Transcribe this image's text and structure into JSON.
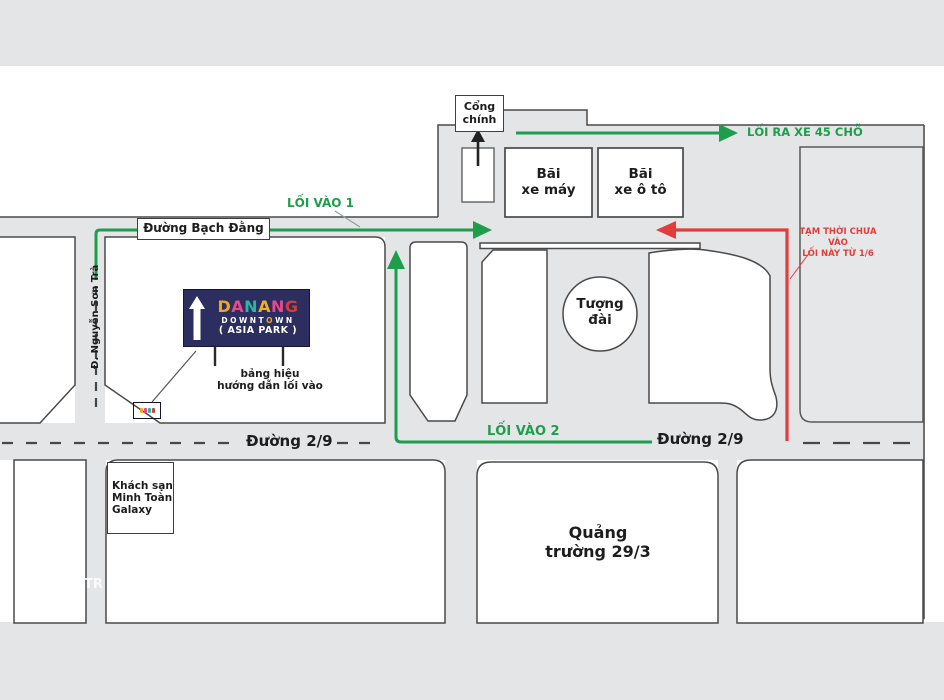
{
  "gate": {
    "label": "Cổng\nchính"
  },
  "parking": {
    "moto": "Bãi\nxe máy",
    "car": "Bãi\nxe ô tô"
  },
  "routes": {
    "exit_bus_label": "LỐI RA XE 45 CHỖ",
    "entrance1_label": "LỐI VÀO 1",
    "entrance2_label": "LỐI VÀO 2",
    "closed_note": "TẠM THỜI CHƯA VÀO\nLỐI NÀY TỪ 1/6"
  },
  "streets": {
    "bach_dang": "Đường Bạch Đằng",
    "nguyen_son_tra": "Đ. Nguyễn Sơn Trà",
    "d29_left": "Đường 2/9",
    "d29_right": "Đường 2/9"
  },
  "places": {
    "monument": "Tượng\nđài",
    "hotel": "Khách sạn\nMinh Toàn\nGalaxy",
    "square": "Quảng\ntrường 29/3"
  },
  "billboard": {
    "bg": "#2b2e5e",
    "title_letters": [
      {
        "ch": "D",
        "color": "#f2a71b"
      },
      {
        "ch": "A",
        "color": "#e8498a"
      },
      {
        "ch": "N",
        "color": "#2ab5a5"
      },
      {
        "ch": "A",
        "color": "#f2b01e"
      },
      {
        "ch": "N",
        "color": "#e8498a"
      },
      {
        "ch": "G",
        "color": "#cf3f39"
      }
    ],
    "subtitle_letters": [
      {
        "ch": "D",
        "color": "#ffffff"
      },
      {
        "ch": "O",
        "color": "#ffffff"
      },
      {
        "ch": "W",
        "color": "#ffffff"
      },
      {
        "ch": "N",
        "color": "#ffffff"
      },
      {
        "ch": "T",
        "color": "#ffffff"
      },
      {
        "ch": "O",
        "color": "#f2a71b"
      },
      {
        "ch": "W",
        "color": "#ffffff"
      },
      {
        "ch": "N",
        "color": "#ffffff"
      }
    ],
    "line3": "( ASIA PARK )",
    "caption": "bảng hiệu\nhướng dẫn lối vào"
  },
  "watermark": "TR",
  "colors": {
    "green": "#1e9e4c",
    "red": "#e23d3d",
    "road_gray": "#e4e5e7",
    "border_gray": "#4a4a4a",
    "billboard_navy": "#2b2e5e"
  }
}
